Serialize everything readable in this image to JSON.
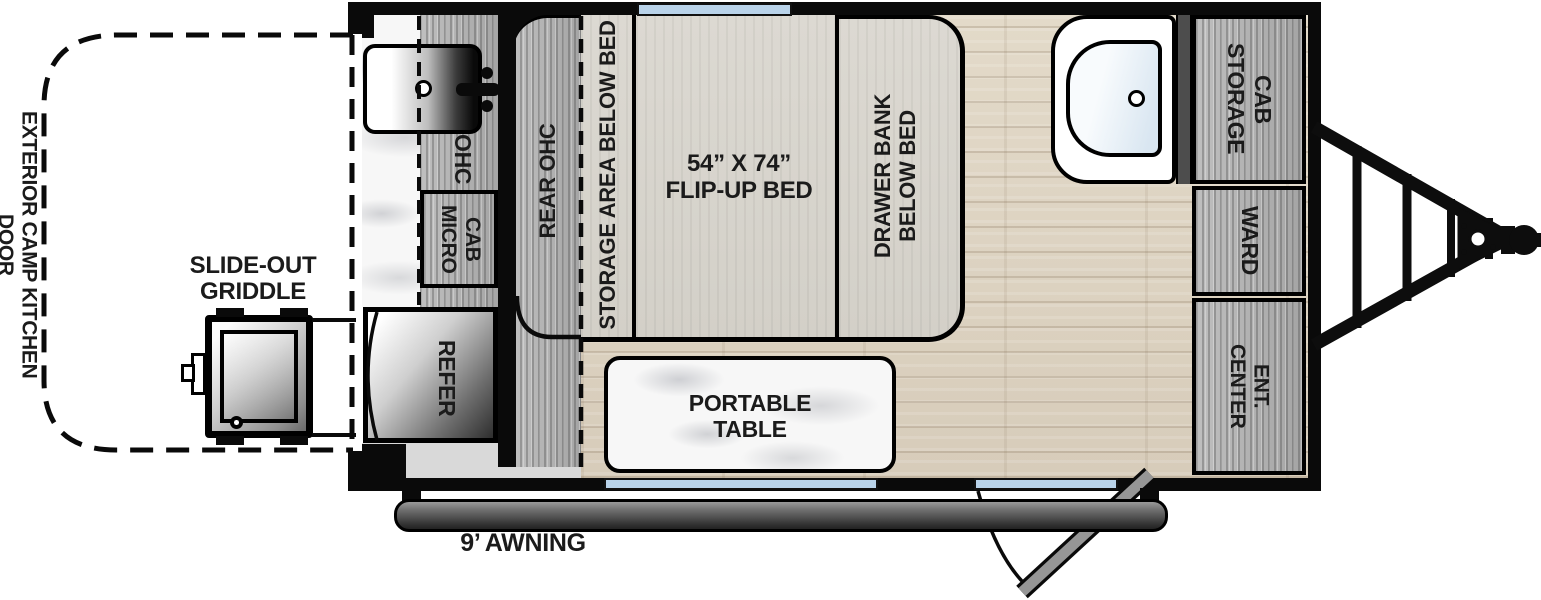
{
  "colors": {
    "wall": "#0a0a0a",
    "window_glass": "#b9d3ea",
    "floor_wood": "#ddd2c0",
    "cabinet_wood": "#b2b2b2",
    "bed_upholstery": "#d9d6cf",
    "marble": "#f7f7f7",
    "awning_gray": "#4a4a4a",
    "door_gray": "#969696",
    "divider_gray": "#4d4d4d",
    "label_text": "#1b1b1b"
  },
  "exterior": {
    "camp_kitchen_door_label": "EXTERIOR CAMP KITCHEN DOOR",
    "griddle_line1": "SLIDE-OUT",
    "griddle_line2": "GRIDDLE",
    "awning_label": "9’ AWNING"
  },
  "kitchen": {
    "ohc_label": "OHC",
    "micro_cab_line1": "MICRO",
    "micro_cab_line2": "CAB",
    "refer_label": "REFER"
  },
  "bed_area": {
    "rear_ohc_label": "REAR OHC",
    "storage_area_label": "STORAGE AREA BELOW BED",
    "bed_size": "54” X 74”",
    "bed_type": "FLIP-UP BED",
    "drawer_bank_line1": "DRAWER BANK",
    "drawer_bank_line2": "BELOW BED"
  },
  "living_area": {
    "table_line1": "PORTABLE",
    "table_line2": "TABLE"
  },
  "front_area": {
    "storage_cab_line1": "STORAGE",
    "storage_cab_line2": "CAB",
    "ward_label": "WARD",
    "ent_center_label": "ENT. CENTER"
  }
}
